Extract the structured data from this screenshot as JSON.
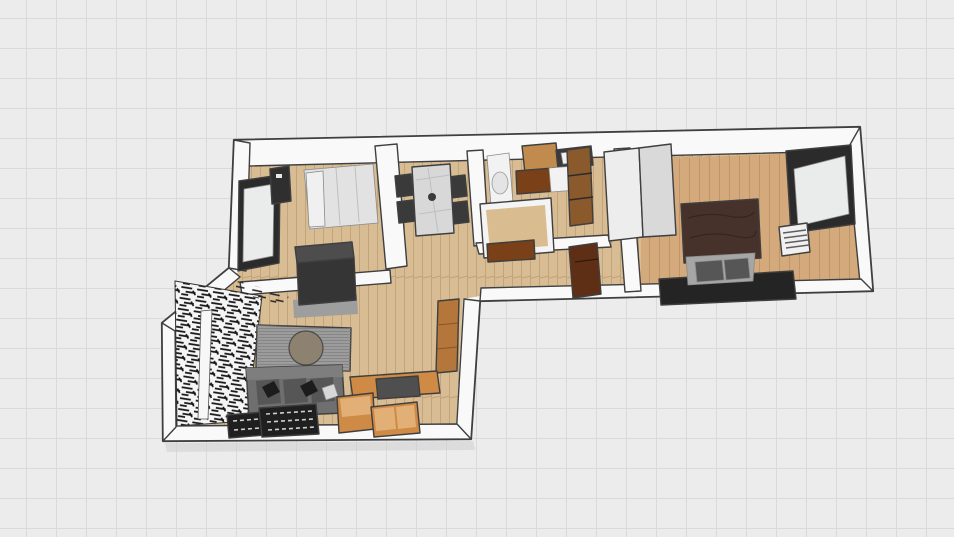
{
  "canvas": {
    "background": "#ececec",
    "grid_line": "#dadada",
    "grid_size_px": 30
  },
  "scene": {
    "type": "3d-floor-plan-render",
    "render_style": "sketch",
    "rooms": [
      {
        "name": "bedroom-left",
        "items": [
          "window-dark-frame",
          "wall-panel-dark",
          "double-bed-white",
          "tall-dark-wardrobe"
        ]
      },
      {
        "name": "dining-area",
        "items": [
          "marble-dining-table",
          "dining-chairs",
          "table-centerpiece"
        ],
        "chair_count": 4
      },
      {
        "name": "bathroom",
        "items": [
          "toilet",
          "wood-upper-cabinet",
          "dark-counter-with-sink",
          "washing-machine",
          "wood-framed-mirror-panel",
          "vanity-unit"
        ]
      },
      {
        "name": "hallway",
        "items": [
          "tall-white-wardrobe",
          "laid-down-door-panel"
        ]
      },
      {
        "name": "bedroom-right",
        "items": [
          "double-bed-brown-blanket",
          "dark-floor-base",
          "window-dark-frame",
          "radiator"
        ]
      },
      {
        "name": "living-room",
        "items": [
          "cluttered-shelving-wall",
          "media-panel-with-round-mirror",
          "gray-sofa",
          "black-throw-pillows",
          "white-throw-pillow",
          "dark-rugs",
          "orange-modular-sofa",
          "dark-coffee-table",
          "tall-wood-column"
        ],
        "rug_count": 2
      }
    ]
  },
  "colors": {
    "wall": "#f9f9f9",
    "ink": "#3f3f3f",
    "floor_wood": "#d8bc94",
    "floor_wood_line": "#c2a178",
    "floor_wood_warm": "#d4aa7c",
    "floor_wood_warm_line": "#bd9367",
    "bed1_duvet": "#e2e2e2",
    "bed1_pillow": "#f0f0f0",
    "wardrobe_dark_top": "#4d4d4d",
    "wardrobe_dark_front": "#353535",
    "wardrobe_shadow": "#9e9e9e",
    "table_marble": "#d8d8d8",
    "chair_dark": "#3a3a3a",
    "cabinet_wood": "#c28b4e",
    "cabinet_front_brown": "#7a4017",
    "panel_wood": "#8a5a2c",
    "counter_dark": "#3a3a3a",
    "appliance_white": "#f2f2f2",
    "tall_unit_front": "#ededed",
    "tall_unit_side": "#d9d9d9",
    "door_brown": "#5e2f14",
    "bed2_blanket": "#46322a",
    "bed2_sheet": "#a6a6a6",
    "bed2_pillow": "#565656",
    "bed2_base": "#242424",
    "window_frame": "#2b2b2b",
    "window_glass": "#e9eceb",
    "radiator_body": "#f0f0f0",
    "media_panel": "#9c9c9c",
    "media_circle": "#8d8270",
    "sofa_gray": "#6f6f6f",
    "sofa_back": "#7e7e7e",
    "sofa_cushion": "#565656",
    "pillow_black": "#1c1c1c",
    "pillow_white": "#d8d8d8",
    "rug_dark": "#1f1f1f",
    "rug_pattern": "#cfcfcf",
    "sectional_orange": "#cf8b45",
    "sectional_light": "#e2b077",
    "sectional_deep": "#b4763a",
    "sectional_table": "#4f4f4f",
    "vanity_frame": "#f4f4f4",
    "vanity_top": "#d9bd90",
    "shadow": "#cfcfcf"
  }
}
